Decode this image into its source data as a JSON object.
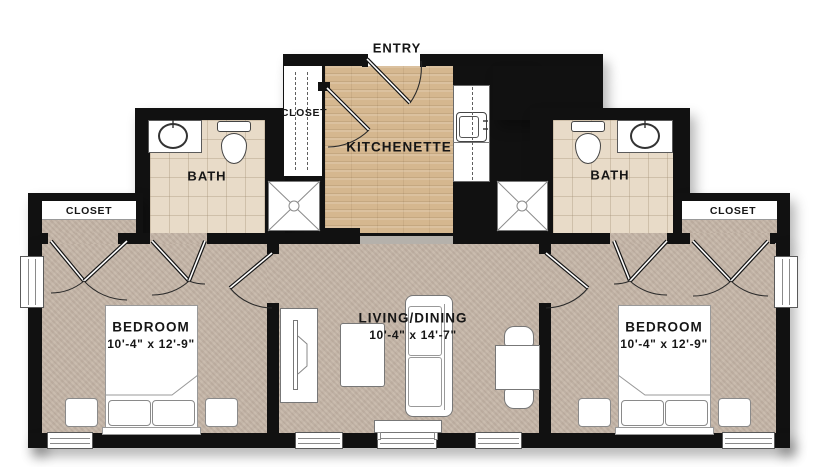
{
  "labels": {
    "entry": "ENTRY",
    "kitchenette": "KITCHENETTE",
    "entry_closet": "CLOSET",
    "bath_left": "BATH",
    "bath_right": "BATH",
    "bedroom_closet_left": "CLOSET",
    "bedroom_closet_right": "CLOSET",
    "bedroom_left_name": "BEDROOM",
    "bedroom_left_dims": "10'-4\" x 12'-9\"",
    "bedroom_right_name": "BEDROOM",
    "bedroom_right_dims": "10'-4\" x 12'-9\"",
    "living_name": "LIVING/DINING",
    "living_dims": "10'-4\" x 14'-7\""
  },
  "colors": {
    "wall": "#111111",
    "wood_floor": "#d5b78f",
    "tile_floor": "#e8dbc8",
    "carpet_floor": "#c7b8aa",
    "fixture_white": "#ffffff",
    "threshold": "#b5b1ab"
  }
}
